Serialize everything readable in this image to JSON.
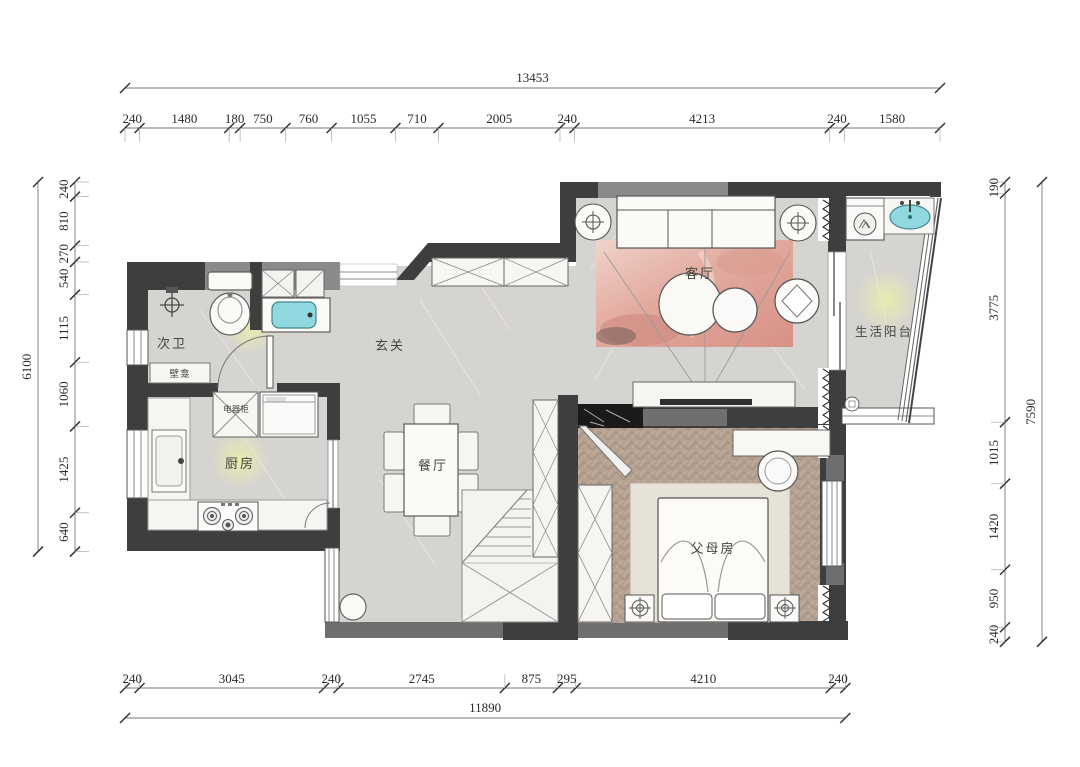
{
  "document": {
    "type": "residential floor plan drawing"
  },
  "rooms": {
    "bathroom": "次卫",
    "niche": "壁龛",
    "appliance_cabinet": "电器柜",
    "foyer": "玄关",
    "kitchen": "厨房",
    "dining": "餐厅",
    "living": "客厅",
    "balcony": "生活阳台",
    "parents_bedroom": "父母房"
  },
  "dimensions": {
    "top": {
      "total": "13453",
      "segments": [
        240,
        1480,
        180,
        750,
        760,
        1055,
        710,
        2005,
        240,
        4213,
        240,
        1580
      ]
    },
    "bottom": {
      "total": "11890",
      "segments": [
        240,
        3045,
        240,
        2745,
        875,
        295,
        4210,
        240
      ]
    },
    "left": {
      "total": "6100",
      "segments": [
        240,
        810,
        270,
        540,
        1115,
        1060,
        1425,
        640
      ]
    },
    "right": {
      "total": "7590",
      "segments": [
        190,
        3775,
        1015,
        1420,
        950,
        240
      ]
    }
  },
  "palette": {
    "wall_dark": "#3e3e3e",
    "wall_gray": "#6f6f6f",
    "wall_light_gray": "#8a8a8a",
    "floor_gray": "#d6d4d1",
    "floor_wood": "#b5a292",
    "rug_pink": "#e2a99e",
    "rug_beige": "#e7e2d8",
    "fixture_white": "#fbfaf7",
    "sink_cyan": "#8fd8df",
    "glow_yellow": "#ecf2a6",
    "marble_black": "#1a1a1a",
    "dim_text": "#2b2b2b"
  }
}
